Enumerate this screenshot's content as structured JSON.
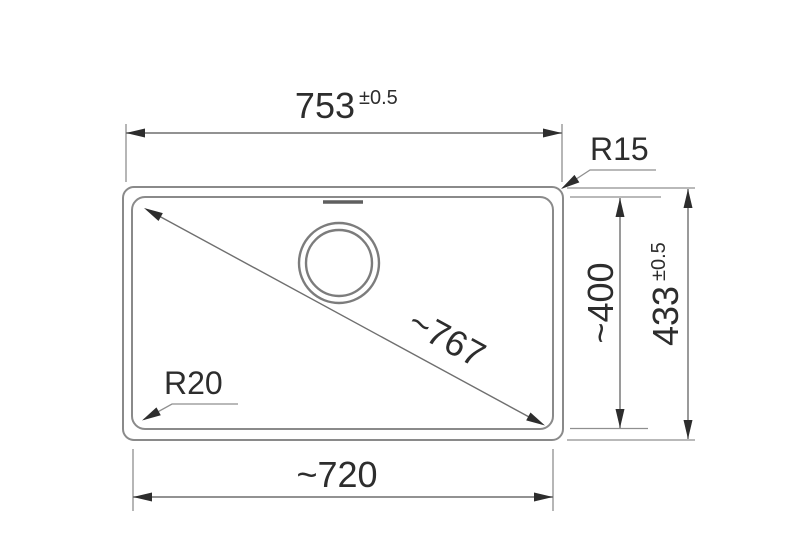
{
  "drawing": {
    "kind": "technical-dimension-drawing",
    "subject": "sink-basin-top-view",
    "line_color": "#8a8a8a",
    "text_color": "#2d2d2d",
    "dimensions": {
      "top_width": {
        "value": "753",
        "tolerance": "±0.5"
      },
      "bottom_width": {
        "value": "~720"
      },
      "inner_height": {
        "value": "~400"
      },
      "outer_height": {
        "value": "433",
        "tolerance": "±0.5"
      },
      "diagonal": {
        "value": "~767"
      },
      "outer_corner_radius": {
        "value": "R15"
      },
      "inner_corner_radius": {
        "value": "R20"
      }
    }
  }
}
